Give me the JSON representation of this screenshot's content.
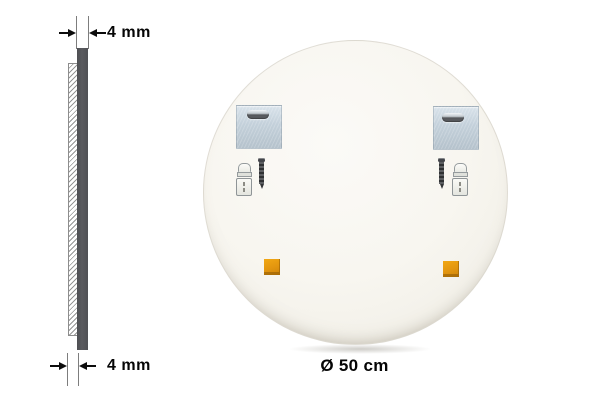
{
  "scene": {
    "type": "mirror-product-dimension-diagram",
    "background_color": "#ffffff"
  },
  "profile": {
    "top_dimension_label": "4 mm",
    "bottom_dimension_label": "4 mm",
    "edge_bar_color": "#55565a",
    "glass_hatch_color": "#969696"
  },
  "mirror_back": {
    "diameter_label": "Ø 50 cm",
    "surface_color": "#f7f5ef",
    "hardware": {
      "bracket_icon": "mounting-plate-with-keyhole-slot",
      "bracket_color": "#c7d4de",
      "anchor_icon": "wall-plug",
      "screw_icon": "screw",
      "pad_icon": "adhesive-pad",
      "pad_color": "#e2950f"
    }
  }
}
